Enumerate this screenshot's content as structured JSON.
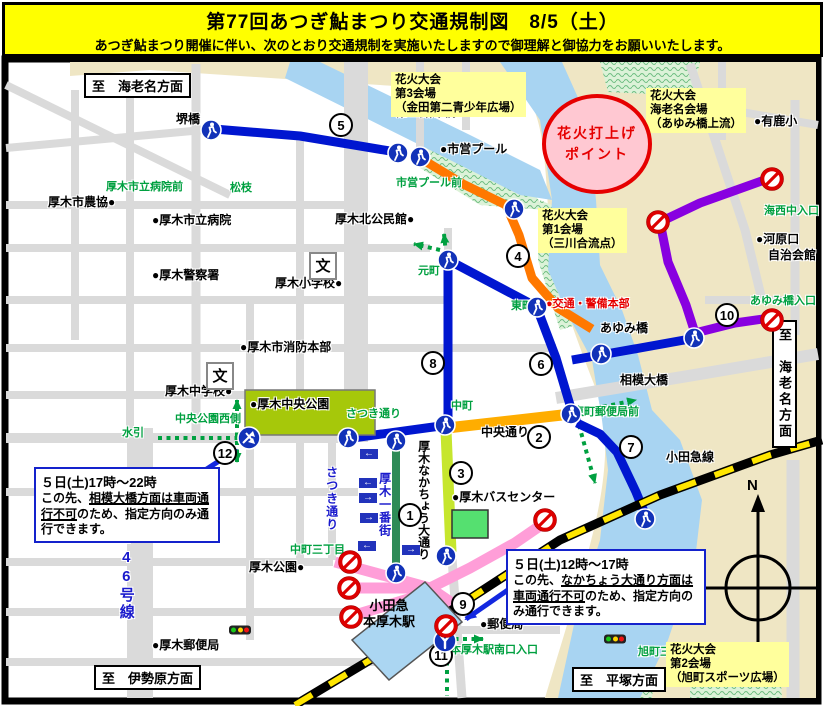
{
  "header": {
    "title": "第77回あつぎ鮎まつり交通規制図　8/5（土）",
    "subtitle": "あつぎ鮎まつり開催に伴い、次のとおり交通規制を実施いたしますので御理解と御協力をお願いいたします。"
  },
  "map": {
    "direction_signs": [
      {
        "text": "至　海老名方面",
        "x": 84,
        "y": 73,
        "vertical": false
      },
      {
        "text": "至　海老名方面",
        "x": 772,
        "y": 320,
        "vertical": true
      },
      {
        "text": "至　伊勢原方面",
        "x": 94,
        "y": 665,
        "vertical": false
      },
      {
        "text": "至　平塚方面",
        "x": 572,
        "y": 667,
        "vertical": false
      }
    ],
    "venues": [
      {
        "lines": [
          "花火大会",
          "第3会場",
          "（金田第二青少年広場）"
        ],
        "x": 391,
        "y": 72
      },
      {
        "lines": [
          "花火大会",
          "海老名会場",
          "（あゆみ橋上流）"
        ],
        "x": 646,
        "y": 88
      },
      {
        "lines": [
          "花火大会",
          "第1会場",
          "（三川合流点）"
        ],
        "x": 538,
        "y": 208
      },
      {
        "lines": [
          "花火大会",
          "第2会場",
          "（旭町スポーツ広場）"
        ],
        "x": 666,
        "y": 642
      }
    ],
    "launch_point": {
      "lines": [
        "花火打上げ",
        "ポイント"
      ],
      "x": 542,
      "y": 94
    },
    "notices": [
      {
        "x": 34,
        "y": 467,
        "w": 172,
        "title": "５日(土)17時～22時",
        "before": "この先、",
        "underline": "相模大橋方面は車両通行不可",
        "after": "のため、指定方向のみ通行できます。"
      },
      {
        "x": 506,
        "y": 549,
        "w": 186,
        "title": "５日(土)12時～17時",
        "before": "この先、",
        "underline": "なかちょう大通り方面は車両通行不可",
        "after": "のため、指定方向のみ通行できます。"
      }
    ],
    "route_numbers": [
      {
        "value": "1",
        "x": 410,
        "y": 515
      },
      {
        "value": "2",
        "x": 539,
        "y": 437
      },
      {
        "value": "3",
        "x": 461,
        "y": 473
      },
      {
        "value": "4",
        "x": 518,
        "y": 256
      },
      {
        "value": "5",
        "x": 341,
        "y": 125
      },
      {
        "value": "6",
        "x": 541,
        "y": 364
      },
      {
        "value": "7",
        "x": 631,
        "y": 447
      },
      {
        "value": "8",
        "x": 433,
        "y": 363
      },
      {
        "value": "9",
        "x": 463,
        "y": 604
      },
      {
        "value": "10",
        "x": 727,
        "y": 315
      },
      {
        "value": "11",
        "x": 441,
        "y": 655
      },
      {
        "value": "12",
        "x": 225,
        "y": 453
      }
    ],
    "labels": [
      {
        "text": "堺橋",
        "cls": "place",
        "x": 176,
        "y": 113
      },
      {
        "text": "第二鮎津橋",
        "cls": "place",
        "x": 396,
        "y": 106
      },
      {
        "text": "●市営プール",
        "cls": "place",
        "x": 440,
        "y": 143
      },
      {
        "text": "市営プール前",
        "cls": "signal",
        "x": 396,
        "y": 178
      },
      {
        "text": "厚木市立病院前",
        "cls": "signal",
        "x": 106,
        "y": 182
      },
      {
        "text": "松枝",
        "cls": "signal",
        "x": 230,
        "y": 183
      },
      {
        "text": "厚木市農協●",
        "cls": "place",
        "x": 48,
        "y": 196
      },
      {
        "text": "●厚木市立病院",
        "cls": "place",
        "x": 152,
        "y": 214
      },
      {
        "text": "●厚木警察署",
        "cls": "place",
        "x": 152,
        "y": 269
      },
      {
        "text": "厚木北公民館●",
        "cls": "place",
        "x": 335,
        "y": 213
      },
      {
        "text": "厚木小学校●",
        "cls": "place",
        "x": 275,
        "y": 277
      },
      {
        "text": "元町",
        "cls": "signal",
        "x": 418,
        "y": 266
      },
      {
        "text": "東町",
        "cls": "signal",
        "x": 511,
        "y": 301
      },
      {
        "text": "●交通・警備本部",
        "cls": "red",
        "x": 546,
        "y": 299
      },
      {
        "text": "あゆみ橋",
        "cls": "place",
        "x": 600,
        "y": 322
      },
      {
        "text": "相模大橋",
        "cls": "place",
        "x": 620,
        "y": 374
      },
      {
        "text": "●厚木市消防本部",
        "cls": "place",
        "x": 240,
        "y": 341
      },
      {
        "text": "厚木中学校●",
        "cls": "place",
        "x": 165,
        "y": 385
      },
      {
        "text": "●厚木中央公園",
        "cls": "place",
        "x": 250,
        "y": 398
      },
      {
        "text": "中央公園西側",
        "cls": "signal",
        "x": 175,
        "y": 414
      },
      {
        "text": "水引",
        "cls": "signal",
        "x": 122,
        "y": 428
      },
      {
        "text": "さつき通り",
        "cls": "signal",
        "x": 346,
        "y": 409
      },
      {
        "text": "中町",
        "cls": "signal",
        "x": 451,
        "y": 401
      },
      {
        "text": "中央通り",
        "cls": "place",
        "x": 481,
        "y": 426
      },
      {
        "text": "東町郵便局前",
        "cls": "signal",
        "x": 573,
        "y": 407
      },
      {
        "text": "小田急線",
        "cls": "place",
        "x": 666,
        "y": 451
      },
      {
        "text": "●有鹿小",
        "cls": "place",
        "x": 754,
        "y": 115
      },
      {
        "text": "海西中入口",
        "cls": "signal",
        "x": 764,
        "y": 206
      },
      {
        "text": "●河原口",
        "cls": "place",
        "x": 756,
        "y": 233
      },
      {
        "text": "自治会館",
        "cls": "place",
        "x": 768,
        "y": 249
      },
      {
        "text": "あゆみ橋入口",
        "cls": "signal",
        "x": 750,
        "y": 296
      },
      {
        "text": "●厚木バスセンター",
        "cls": "place",
        "x": 452,
        "y": 491
      },
      {
        "text": "中町三丁目",
        "cls": "signal",
        "x": 290,
        "y": 545
      },
      {
        "text": "厚木公園●",
        "cls": "place",
        "x": 249,
        "y": 561
      },
      {
        "text": "●郵便局",
        "cls": "place",
        "x": 480,
        "y": 618
      },
      {
        "text": "本厚木駅南口入口",
        "cls": "signal",
        "x": 450,
        "y": 645
      },
      {
        "text": "●厚木郵便局",
        "cls": "place",
        "x": 152,
        "y": 639
      },
      {
        "text": "旭町三丁目",
        "cls": "signal",
        "x": 638,
        "y": 647
      },
      {
        "text": "N",
        "cls": "compass",
        "x": 747,
        "y": 478
      },
      {
        "text": "さつき通り",
        "cls": "v-blue",
        "x": 325,
        "y": 466
      },
      {
        "text": "厚木一番街",
        "cls": "v-blue",
        "x": 378,
        "y": 472
      },
      {
        "text": "厚木なかちょう大通り",
        "cls": "v-black",
        "x": 417,
        "y": 440
      },
      {
        "text": "国道246号線",
        "cls": "v-246",
        "x": 118,
        "y": 496
      }
    ],
    "station": {
      "lines": [
        "小田急",
        "本厚木駅"
      ],
      "x": 398,
      "y": 614
    },
    "icons": [
      {
        "type": "pedestrian",
        "x": 211,
        "y": 130
      },
      {
        "type": "pedestrian",
        "x": 398,
        "y": 153
      },
      {
        "type": "pedestrian",
        "x": 420,
        "y": 157
      },
      {
        "type": "pedestrian",
        "x": 514,
        "y": 209
      },
      {
        "type": "pedestrian",
        "x": 448,
        "y": 260
      },
      {
        "type": "pedestrian",
        "x": 537,
        "y": 307
      },
      {
        "type": "pedestrian",
        "x": 601,
        "y": 354
      },
      {
        "type": "pedestrian",
        "x": 694,
        "y": 338
      },
      {
        "type": "pedestrian",
        "x": 571,
        "y": 414
      },
      {
        "type": "pedestrian",
        "x": 445,
        "y": 425
      },
      {
        "type": "pedestrian",
        "x": 348,
        "y": 438
      },
      {
        "type": "pedestrian",
        "x": 396,
        "y": 441
      },
      {
        "type": "pedestrian",
        "x": 396,
        "y": 573
      },
      {
        "type": "pedestrian",
        "x": 446,
        "y": 556
      },
      {
        "type": "pedestrian",
        "x": 645,
        "y": 519
      },
      {
        "type": "crossing",
        "x": 249,
        "y": 438
      },
      {
        "type": "junction-y",
        "x": 445,
        "y": 641
      },
      {
        "type": "no-entry",
        "x": 772,
        "y": 179
      },
      {
        "type": "no-entry",
        "x": 658,
        "y": 222
      },
      {
        "type": "no-entry",
        "x": 772,
        "y": 320
      },
      {
        "type": "no-entry",
        "x": 545,
        "y": 520
      },
      {
        "type": "no-entry",
        "x": 350,
        "y": 562
      },
      {
        "type": "no-entry",
        "x": 349,
        "y": 588
      },
      {
        "type": "no-entry",
        "x": 351,
        "y": 617
      },
      {
        "type": "no-entry",
        "x": 446,
        "y": 626
      },
      {
        "type": "traffic-light",
        "x": 240,
        "y": 630
      },
      {
        "type": "traffic-light",
        "x": 615,
        "y": 639
      },
      {
        "type": "school",
        "x": 323,
        "y": 266
      },
      {
        "type": "school",
        "x": 220,
        "y": 376
      },
      {
        "type": "oneway-left",
        "x": 369,
        "y": 454
      },
      {
        "type": "oneway-left",
        "x": 368,
        "y": 483
      },
      {
        "type": "oneway-right",
        "x": 368,
        "y": 498
      },
      {
        "type": "oneway-right",
        "x": 369,
        "y": 518
      },
      {
        "type": "oneway-left",
        "x": 367,
        "y": 546
      },
      {
        "type": "oneway-right",
        "x": 411,
        "y": 550
      }
    ],
    "colors": {
      "regulated_blue": "#0016D0",
      "regulated_orange": "#FF7800",
      "chuo_dori_orange": "#FFAD00",
      "nakacho_yellow_green": "#C6E62E",
      "ichibangai_green": "#2E8B57",
      "station_area_pink": "#FF9ED8",
      "purple_route": "#8800E0",
      "railway_yellow": "#FFE600",
      "pedestrian_route_green": "#00A040",
      "river_blue": "#A8D4F2",
      "land_beige": "#EFE6C4",
      "park_green": "#A6C80A",
      "header_yellow": "#FFFF00",
      "notice_border_blue": "#1422CC",
      "launch_pink": "#FFC8D2",
      "launch_red": "#E60000"
    }
  }
}
